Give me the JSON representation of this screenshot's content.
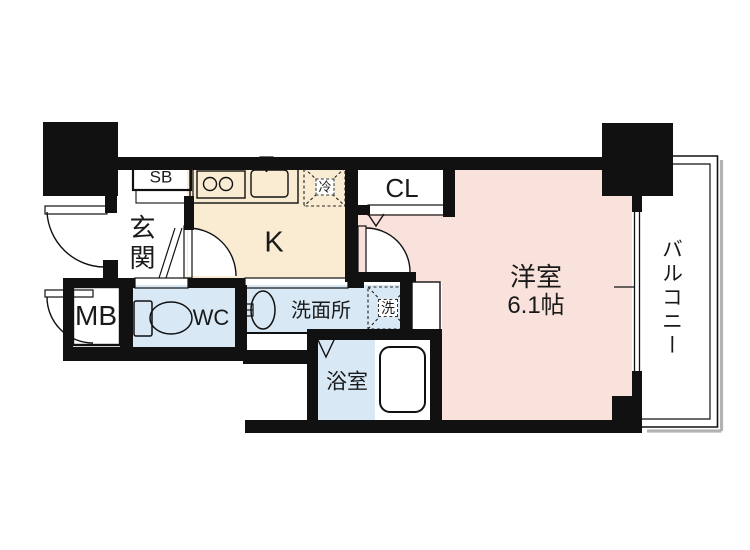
{
  "plan": {
    "type": "floor-plan",
    "colors": {
      "wall": "#111111",
      "kitchen_floor": "#FAECD2",
      "room_floor": "#F9E2DC",
      "wet_floor": "#D8E9F5",
      "balcony_shadow": "#b3b3b3"
    },
    "rooms": {
      "entrance": {
        "label": "玄関"
      },
      "shoe_box": {
        "label": "SB"
      },
      "kitchen": {
        "label": "K"
      },
      "refrigerator": {
        "label": "冷"
      },
      "closet": {
        "label": "CL"
      },
      "meter_box": {
        "label": "MB"
      },
      "toilet": {
        "label": "WC"
      },
      "washroom": {
        "label": "洗面所"
      },
      "laundry": {
        "label": "洗"
      },
      "bathroom": {
        "label": "浴室"
      },
      "main_room": {
        "label": "洋室",
        "size": "6.1帖"
      },
      "balcony": {
        "label": "バルコニー"
      }
    },
    "fixtures": [
      "stove-icon",
      "kitchen-sink-icon",
      "refrigerator-space-icon",
      "toilet-icon",
      "wash-basin-icon",
      "bathtub-icon",
      "washing-machine-space-icon",
      "entrance-door-arc-icon",
      "kitchen-door-arc-icon",
      "room-door-arc-icon",
      "meter-box-door-arc-icon",
      "closet-folding-mark-icon",
      "bath-folding-door-icon",
      "sliding-window-icon",
      "entrance-step-icon"
    ]
  }
}
